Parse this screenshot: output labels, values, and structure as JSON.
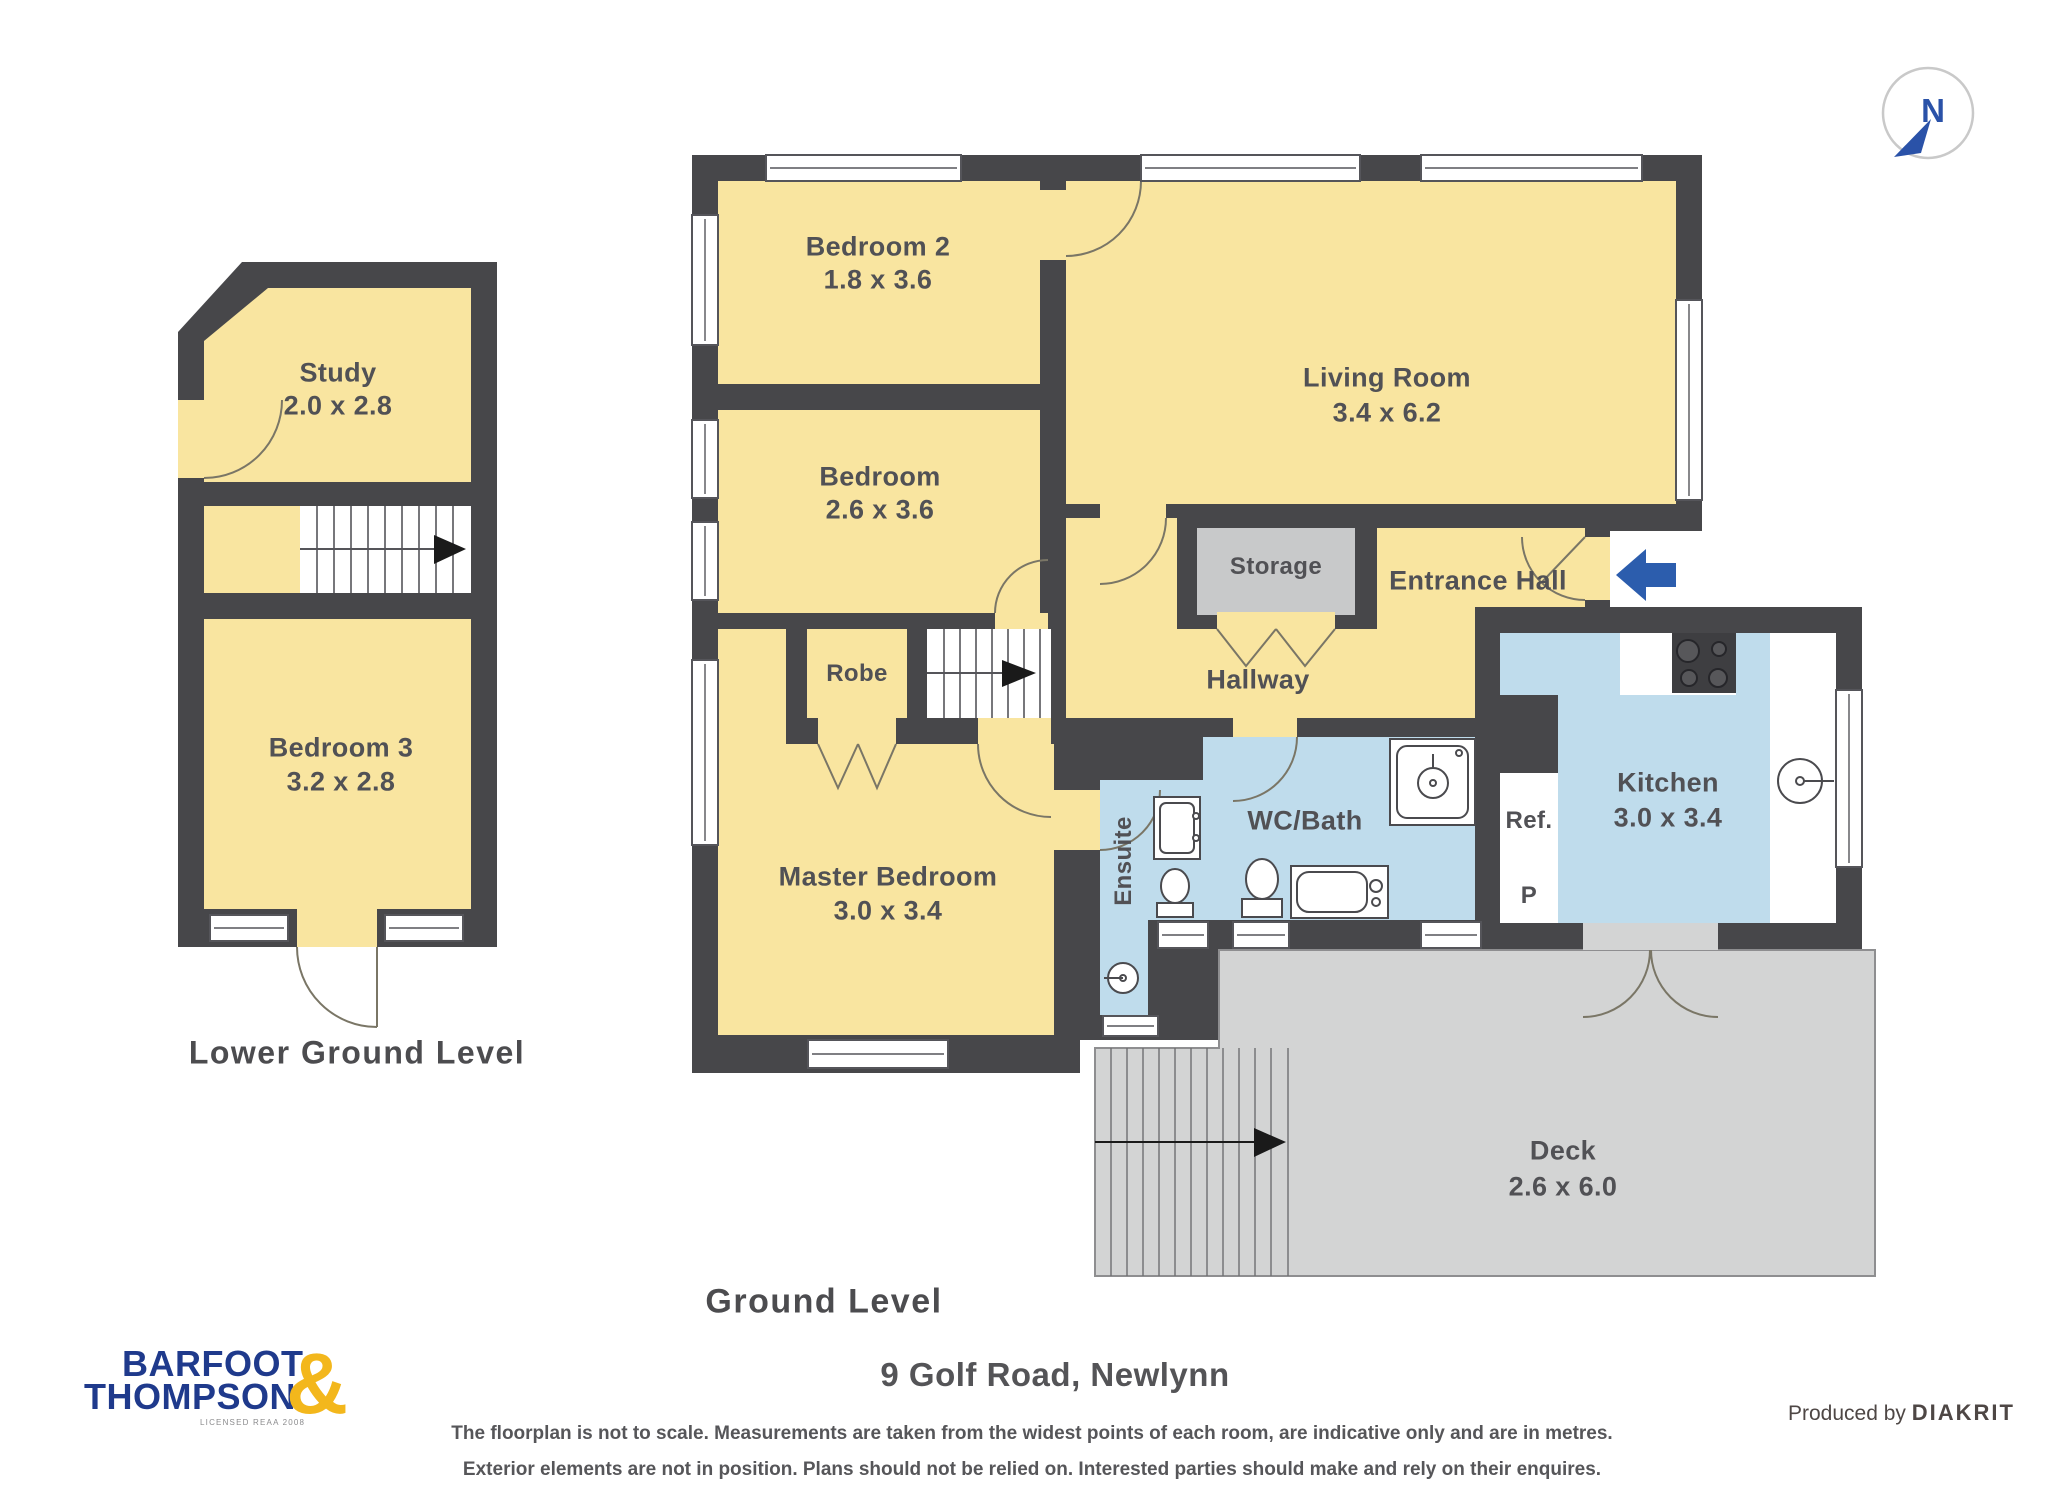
{
  "compass": {
    "north_label": "N"
  },
  "lower_plan": {
    "title": "Lower Ground Level",
    "rooms": {
      "study": {
        "name": "Study",
        "dims": "2.0 x 2.8"
      },
      "bedroom3": {
        "name": "Bedroom 3",
        "dims": "3.2 x 2.8"
      }
    }
  },
  "ground_plan": {
    "title": "Ground Level",
    "rooms": {
      "bedroom2": {
        "name": "Bedroom 2",
        "dims": "1.8 x 3.6"
      },
      "bedroom": {
        "name": "Bedroom",
        "dims": "2.6 x 3.6"
      },
      "living": {
        "name": "Living Room",
        "dims": "3.4 x 6.2"
      },
      "storage": {
        "name": "Storage"
      },
      "entrance": {
        "name": "Entrance Hall"
      },
      "hallway": {
        "name": "Hallway"
      },
      "robe": {
        "name": "Robe"
      },
      "master": {
        "name": "Master Bedroom",
        "dims": "3.0 x 3.4"
      },
      "ensuite": {
        "name": "Ensuite"
      },
      "wcbath": {
        "name": "WC/Bath"
      },
      "ref": {
        "name": "Ref."
      },
      "pantry": {
        "name": "P"
      },
      "kitchen": {
        "name": "Kitchen",
        "dims": "3.0 x 3.4"
      },
      "deck": {
        "name": "Deck",
        "dims": "2.6 x 6.0"
      }
    }
  },
  "footer": {
    "address": "9 Golf Road, Newlynn",
    "disclaimer_line1": "The floorplan is not to scale. Measurements are taken from the widest points of each room, are indicative only and are in metres.",
    "disclaimer_line2": "Exterior elements are not in position. Plans should not be relied on. Interested parties should make and rely on their enquires.",
    "produced_by": "Produced by",
    "producer": "DIAKRIT",
    "logo": {
      "line1": "BARFOOT",
      "line2": "THOMPSON",
      "ampersand": "&",
      "license": "LICENSED REAA 2008"
    }
  },
  "colors": {
    "wall": "#47474a",
    "room_yellow": "#f9e5a0",
    "wet_blue": "#bfdcec",
    "storage_gray": "#c8c9ca",
    "deck_gray": "#d3d4d4",
    "accent_blue": "#2c5dad",
    "logo_navy": "#1f3a8c",
    "logo_gold": "#f3b71c"
  }
}
